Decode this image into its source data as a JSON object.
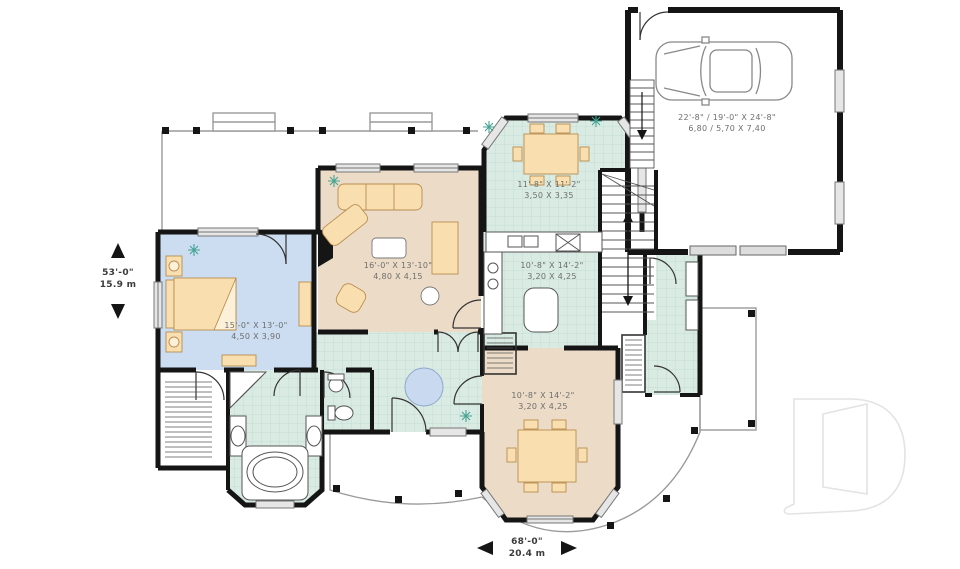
{
  "plan": {
    "overall": {
      "depth": {
        "imperial": "53'-0\"",
        "metric": "15.9 m"
      },
      "width": {
        "imperial": "68'-0\"",
        "metric": "20.4 m"
      }
    },
    "rooms": {
      "dinette": {
        "imperial": "11'-8\" X 11'-2\"",
        "metric": "3,50 X 3,35"
      },
      "living_room": {
        "imperial": "16'-0\" X 13'-10\"",
        "metric": "4,80 X 4,15"
      },
      "kitchen": {
        "imperial": "10'-8\" X 14'-2\"",
        "metric": "3,20 X 4,25"
      },
      "bedroom": {
        "imperial": "15'-0\" X 13'-0\"",
        "metric": "4,50 X 3,90"
      },
      "dining_room": {
        "imperial": "10'-8\" X 14'-2\"",
        "metric": "3,20 X 4,25"
      },
      "garage": {
        "imperial": "22'-8\" / 19'-0\" X 24'-8\"",
        "metric": "6,80 / 5,70 X 7,40"
      }
    },
    "colors": {
      "tile_floor": "#d9ebe3",
      "tile_grid": "#bcd9cf",
      "wood_floor": "#ecdcc7",
      "bedroom_floor": "#ccddf1",
      "furniture": "#f9deb0",
      "furniture_stroke": "#b98d4f",
      "rug": "#c9d9ef",
      "wall": "#151515",
      "window_fill": "#e6e6e6",
      "plant": "#44a392",
      "porch_line": "#9a9a9a",
      "watermark": "#e3e3e3"
    }
  }
}
